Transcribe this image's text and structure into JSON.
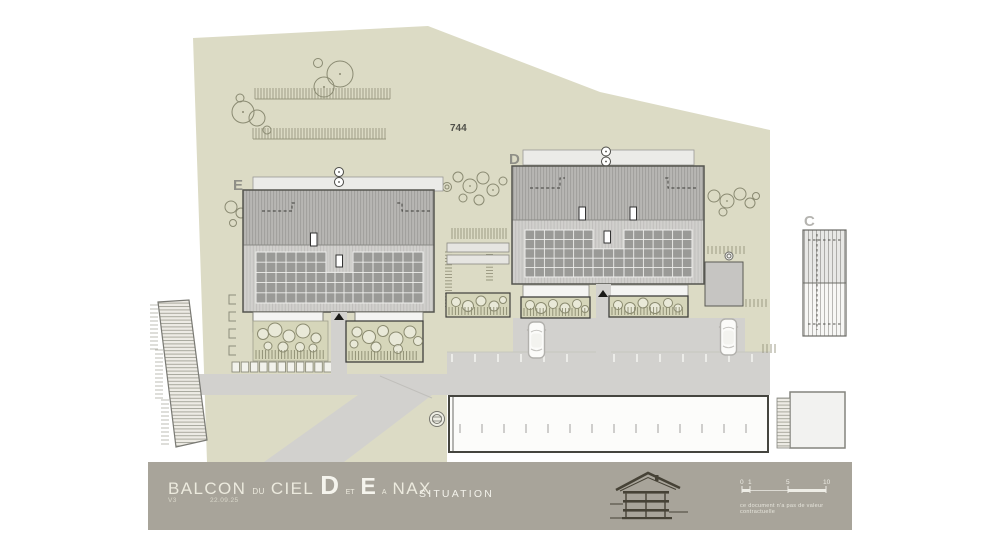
{
  "plan": {
    "parcel_number": "744",
    "buildings": {
      "e_label": "E",
      "d_label": "D",
      "c_label": "C"
    }
  },
  "title_block": {
    "project_title": {
      "balcon": "BALCON",
      "du": "DU",
      "ciel": "CIEL",
      "d": "D",
      "et": "ET",
      "e": "E",
      "a": "A",
      "nax": "NAX"
    },
    "version": "V3",
    "date": "22.09.25",
    "sheet_name": "SITUATION",
    "disclaimer": "ce document n'a pas de valeur contractuelle",
    "scale_bar": {
      "labels": [
        "0",
        "1",
        "5",
        "10"
      ]
    }
  },
  "colors": {
    "parcel": "#dcdbc5",
    "road": "#d2d1ce",
    "title_bar": "#a8a49a",
    "solar_panel": "#9a9a97"
  }
}
